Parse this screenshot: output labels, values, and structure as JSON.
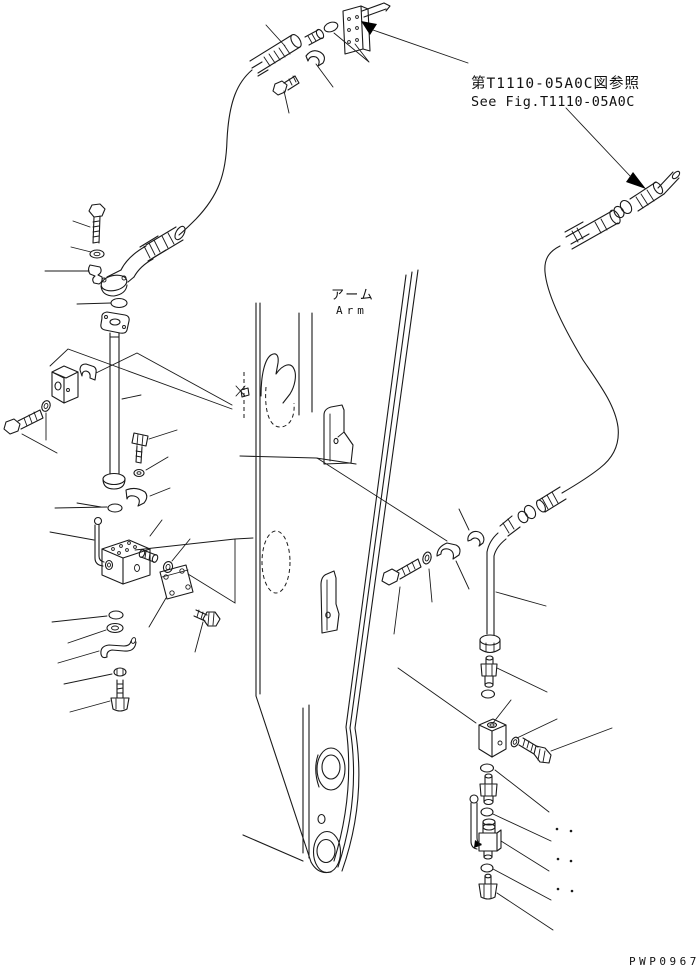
{
  "annotations": {
    "reference_note_jp": "第T1110-05A0C図参照",
    "reference_note_en": "See Fig.T1110-05A0C",
    "arm_label_jp": "アーム",
    "arm_label_en": "Arm",
    "drawing_number": "PWP0967"
  },
  "colors": {
    "line": "#1a1a1a",
    "background": "#ffffff",
    "reference_arrow_fill": "#000000"
  },
  "icons": {
    "reference_arrow": "solid-black-arrowhead",
    "leader_end_dots": "paired-small-dots"
  }
}
